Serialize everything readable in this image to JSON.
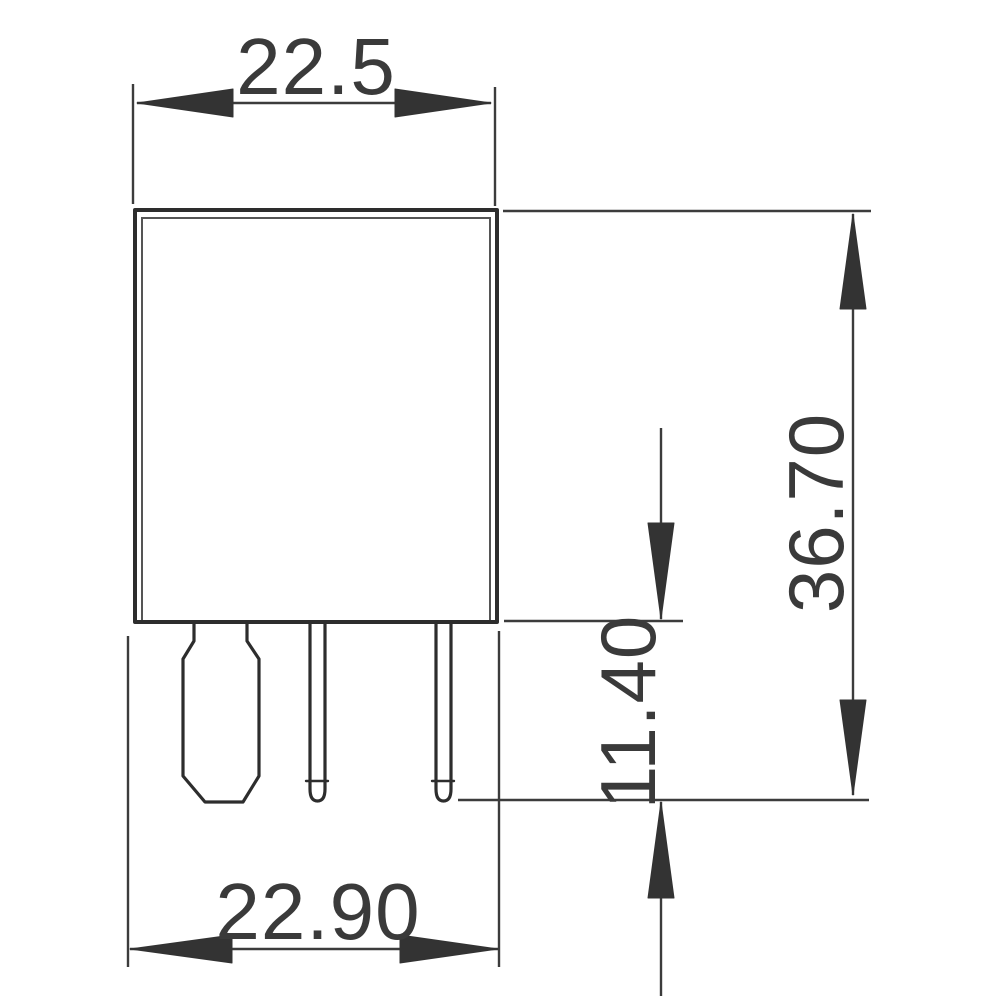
{
  "drawing": {
    "colors": {
      "background": "#ffffff",
      "outline": "#2d2d2d",
      "dimension_lines": "#3c3c3c",
      "text": "#3a3a3a"
    },
    "dimensions": {
      "top_width": "22.5",
      "base_width": "22.90",
      "overall_height": "36.70",
      "pin_length": "11.40"
    }
  }
}
